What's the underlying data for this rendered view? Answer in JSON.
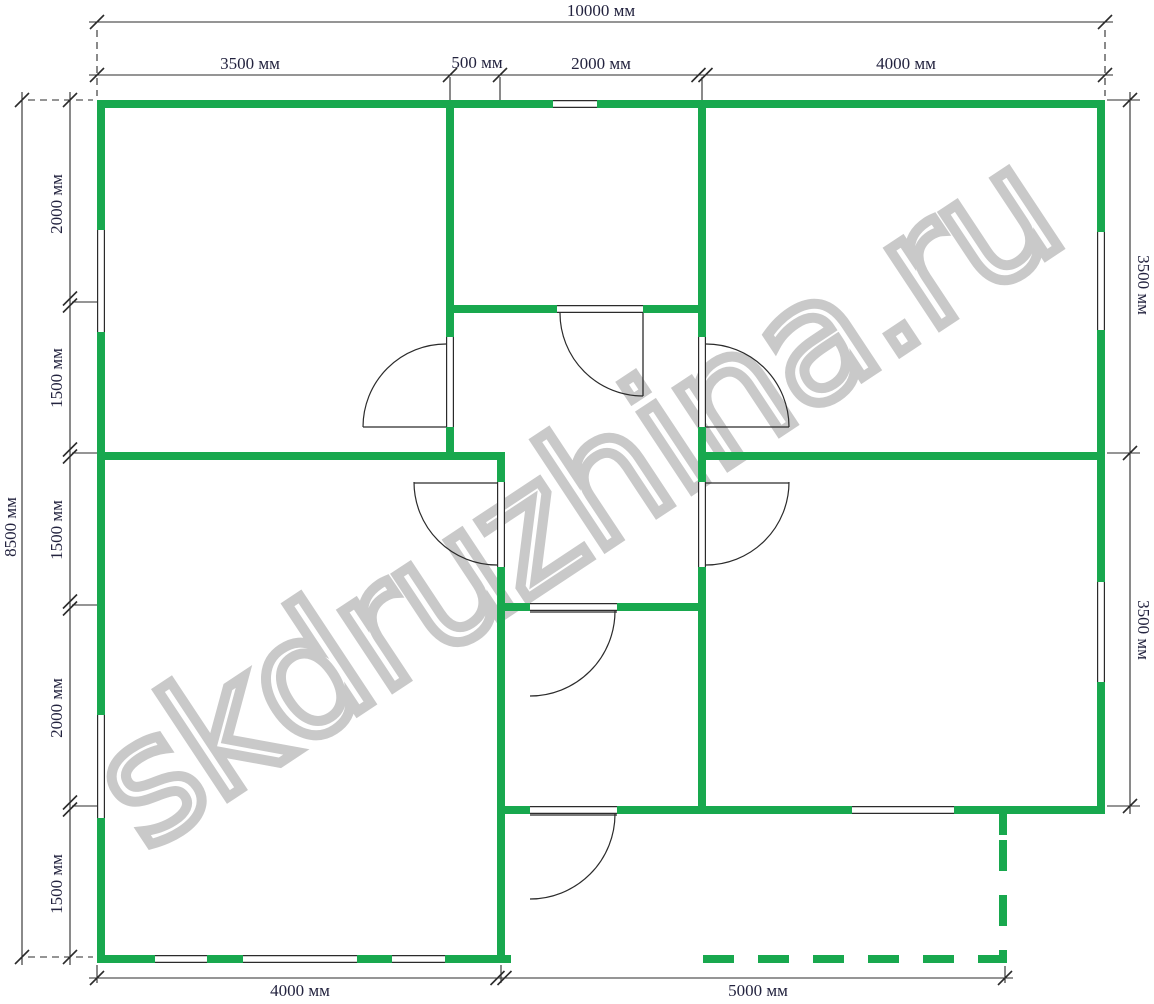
{
  "watermark": {
    "text": "skdruzhina.ru",
    "cx": 575,
    "cy": 498,
    "angle_deg": -33.5,
    "font_px": 168,
    "outline_color": "#c9c9c9",
    "letter_spacing_px": -3
  },
  "colors": {
    "wall_green": "#18a84e",
    "line": "#2b2b2b",
    "label": "#23233f",
    "background": "#ffffff"
  },
  "plan": {
    "canvas_w": 1154,
    "canvas_h": 1004,
    "wall_px": 8,
    "walls": [
      [
        97,
        100,
        1008,
        8
      ],
      [
        97,
        100,
        8,
        863
      ],
      [
        1097,
        100,
        8,
        714
      ],
      [
        97,
        955,
        414,
        8
      ],
      [
        446,
        108,
        8,
        352
      ],
      [
        446,
        305,
        260,
        8
      ],
      [
        698,
        108,
        8,
        706
      ],
      [
        105,
        452,
        400,
        8
      ],
      [
        497,
        452,
        8,
        511
      ],
      [
        706,
        452,
        391,
        8
      ],
      [
        497,
        603,
        209,
        8
      ],
      [
        505,
        806,
        592,
        8
      ],
      [
        999,
        814,
        8,
        21
      ]
    ],
    "dashed_walls": [
      {
        "x1": 703,
        "y1": 959,
        "x2": 1007,
        "y2": 959,
        "dash": "31 24"
      },
      {
        "x1": 1003,
        "y1": 840,
        "x2": 1003,
        "y2": 963,
        "dash": "31 24"
      }
    ],
    "window_openings_h": [
      [
        553,
        100,
        44
      ],
      [
        852,
        806,
        102
      ],
      [
        155,
        955,
        52
      ],
      [
        243,
        955,
        114
      ],
      [
        392,
        955,
        53
      ]
    ],
    "window_openings_v": [
      [
        97,
        230,
        102
      ],
      [
        97,
        715,
        103
      ],
      [
        1097,
        232,
        98
      ],
      [
        1097,
        582,
        100
      ]
    ],
    "door_openings_h": [
      [
        557,
        305,
        86
      ],
      [
        530,
        603,
        87
      ],
      [
        530,
        806,
        87
      ]
    ],
    "door_openings_v": [
      [
        446,
        337,
        90
      ],
      [
        698,
        337,
        90
      ],
      [
        497,
        482,
        85
      ],
      [
        698,
        482,
        85
      ]
    ],
    "doors": [
      {
        "leaf": [
          446,
          427,
          363,
          427
        ],
        "arc": "M363,427 A83,83 0 0 1 446,344"
      },
      {
        "leaf": [
          643,
          313,
          643,
          396
        ],
        "arc": "M560,313 A83,83 0 0 0 643,396"
      },
      {
        "leaf": [
          706,
          427,
          789,
          427
        ],
        "arc": "M706,344 A83,83 0 0 1 789,427"
      },
      {
        "leaf": [
          497,
          483,
          414,
          483
        ],
        "arc": "M414,482 A83,83 0 0 0 497,565"
      },
      {
        "leaf": [
          706,
          483,
          789,
          483
        ],
        "arc": "M789,482 A83,83 0 0 1 706,565"
      },
      {
        "leaf": [
          530,
          612,
          617,
          612
        ],
        "arc": "M615,611 A85,85 0 0 1 530,696"
      },
      {
        "leaf": [
          530,
          815,
          617,
          815
        ],
        "arc": "M615,814 A85,85 0 0 1 530,899"
      }
    ]
  },
  "dimensions": {
    "lines": [
      {
        "o": "h",
        "c": 22,
        "a": 89,
        "b": 1113,
        "ticks": [
          [
            97,
            1
          ],
          [
            1105,
            1
          ]
        ]
      },
      {
        "o": "h",
        "c": 75,
        "a": 89,
        "b": 1113,
        "ticks": [
          [
            97,
            1
          ],
          [
            450,
            1
          ],
          [
            500,
            1
          ],
          [
            702,
            2
          ],
          [
            1105,
            1
          ]
        ]
      },
      {
        "o": "v",
        "c": 22,
        "a": 92,
        "b": 965,
        "ticks": [
          [
            100,
            1
          ],
          [
            957,
            1
          ]
        ]
      },
      {
        "o": "v",
        "c": 70,
        "a": 92,
        "b": 965,
        "ticks": [
          [
            100,
            1
          ],
          [
            302,
            2
          ],
          [
            453,
            2
          ],
          [
            605,
            2
          ],
          [
            806,
            2
          ],
          [
            957,
            1
          ]
        ]
      },
      {
        "o": "v",
        "c": 1130,
        "a": 92,
        "b": 814,
        "ticks": [
          [
            100,
            1
          ],
          [
            453,
            1
          ],
          [
            806,
            1
          ]
        ]
      },
      {
        "o": "h",
        "c": 978,
        "a": 89,
        "b": 1013,
        "ticks": [
          [
            97,
            1
          ],
          [
            501,
            2
          ],
          [
            1005,
            1
          ]
        ]
      }
    ],
    "ext_solid": [
      [
        450,
        77,
        450,
        100
      ],
      [
        500,
        77,
        500,
        100
      ],
      [
        702,
        77,
        702,
        100
      ],
      [
        72,
        302,
        97,
        302
      ],
      [
        72,
        453,
        97,
        453
      ],
      [
        72,
        605,
        97,
        605
      ],
      [
        72,
        806,
        97,
        806
      ],
      [
        1107,
        100,
        1140,
        100
      ],
      [
        1107,
        453,
        1140,
        453
      ],
      [
        1107,
        806,
        1140,
        806
      ],
      [
        97,
        965,
        97,
        983
      ],
      [
        501,
        965,
        501,
        983
      ],
      [
        1005,
        966,
        1005,
        983
      ]
    ],
    "ext_dashed": [
      [
        97,
        30,
        97,
        96
      ],
      [
        1105,
        30,
        1105,
        96
      ],
      [
        28,
        100,
        93,
        100
      ],
      [
        28,
        957,
        93,
        957
      ]
    ],
    "labels": [
      {
        "text": "10000 мм",
        "x": 601,
        "y": 11,
        "rot": 0
      },
      {
        "text": "3500 мм",
        "x": 250,
        "y": 64,
        "rot": 0
      },
      {
        "text": "500 мм",
        "x": 477,
        "y": 63,
        "rot": 0
      },
      {
        "text": "2000 мм",
        "x": 601,
        "y": 64,
        "rot": 0
      },
      {
        "text": "4000 мм",
        "x": 906,
        "y": 64,
        "rot": 0
      },
      {
        "text": "8500 мм",
        "x": 11,
        "y": 527,
        "rot": -90
      },
      {
        "text": "2000 мм",
        "x": 57,
        "y": 204,
        "rot": -90
      },
      {
        "text": "1500 мм",
        "x": 57,
        "y": 378,
        "rot": -90
      },
      {
        "text": "1500 мм",
        "x": 57,
        "y": 530,
        "rot": -90
      },
      {
        "text": "2000 мм",
        "x": 57,
        "y": 708,
        "rot": -90
      },
      {
        "text": "1500 мм",
        "x": 57,
        "y": 884,
        "rot": -90
      },
      {
        "text": "3500 мм",
        "x": 1143,
        "y": 285,
        "rot": 90
      },
      {
        "text": "3500 мм",
        "x": 1143,
        "y": 630,
        "rot": 90
      },
      {
        "text": "4000 мм",
        "x": 300,
        "y": 991,
        "rot": 0
      },
      {
        "text": "5000 мм",
        "x": 758,
        "y": 991,
        "rot": 0
      }
    ]
  }
}
